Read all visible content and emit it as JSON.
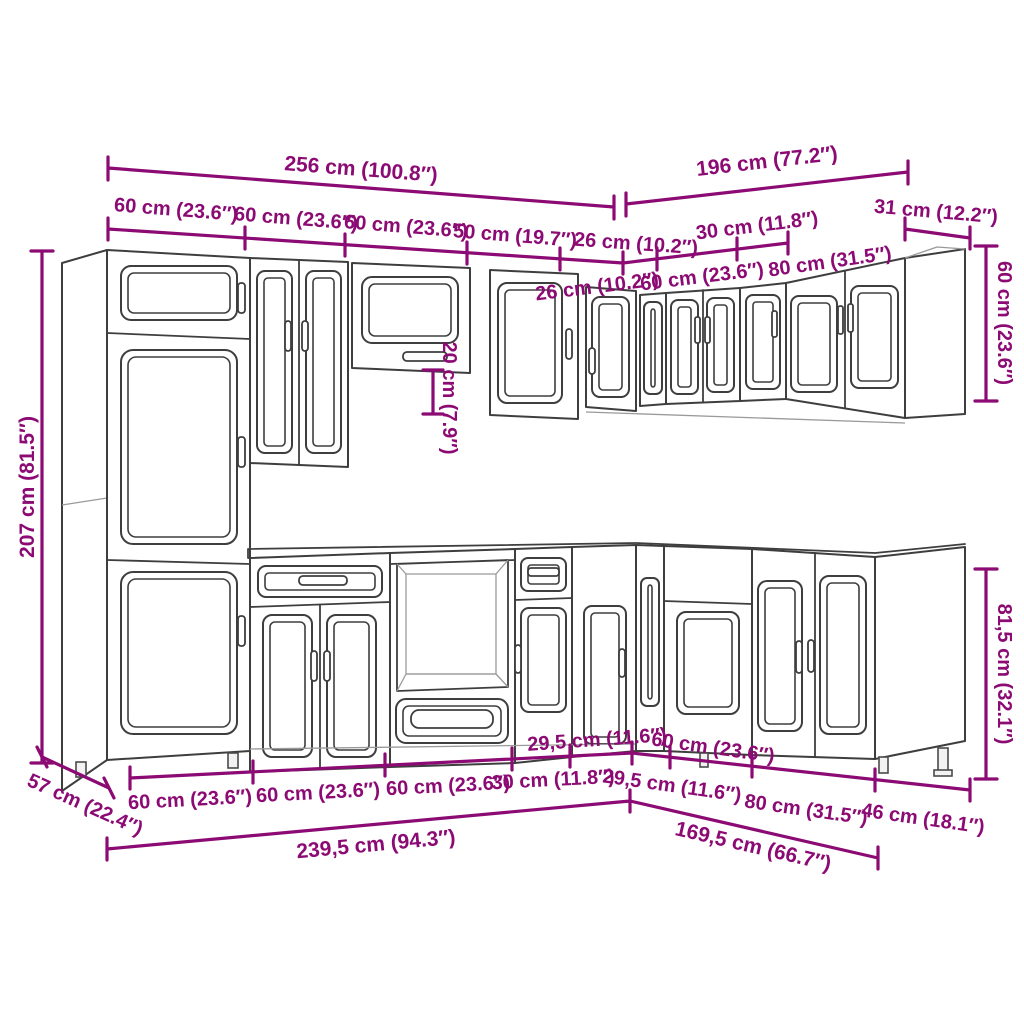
{
  "diagram": {
    "type": "kitchen-cabinet-set-dimension-drawing",
    "colors": {
      "dimension": "#8c0a73",
      "outline": "#3e3e3e",
      "outline_light": "#9a9a9a",
      "background": "#ffffff"
    },
    "dimensions": {
      "top_totals": {
        "left": "256 cm (100.8″)",
        "right": "196 cm (77.2″)"
      },
      "top_segments_left": [
        "60 cm (23.6″)",
        "60 cm (23.6″)",
        "60 cm (23.6″)",
        "50 cm (19.7″)",
        "26 cm (10.2″)"
      ],
      "top_segments_right_above": [
        "30 cm (11.8″)",
        "31 cm (12.2″)"
      ],
      "top_segments_right_below": [
        "26 cm (10.2″)",
        "60 cm (23.6″)",
        "80 cm (31.5″)"
      ],
      "height_total_left": "207 cm (81.5″)",
      "wall_gap_middle": "20 cm (7.9″)",
      "wall_cabinet_height_right": "60 cm (23.6″)",
      "base_cabinet_height_right": "81,5 cm (32.1″)",
      "depth_left": "57 cm (22.4″)",
      "bottom_segments_left": [
        "60 cm (23.6″)",
        "60 cm (23.6″)",
        "60 cm (23.6″)",
        "30 cm (11.8″)",
        "29,5 cm (11.6″)"
      ],
      "bottom_segments_right": [
        "29,5 cm (11.6″)",
        "60 cm (23.6″)",
        "80 cm (31.5″)",
        "46 cm (18.1″)"
      ],
      "bottom_totals": {
        "left": "239,5 cm (94.3″)",
        "right": "169,5 cm (66.7″)"
      }
    }
  }
}
